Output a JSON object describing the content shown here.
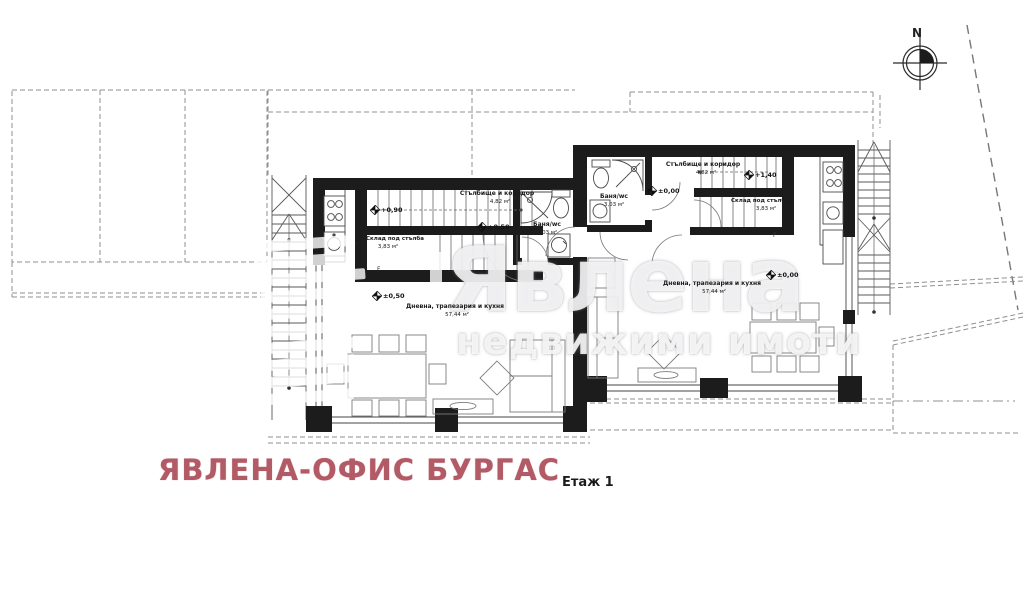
{
  "watermark": {
    "brand": "Явлена",
    "tagline": "недвижими имоти"
  },
  "title_block": {
    "office": "ЯВЛЕНА-ОФИС БУРГАС",
    "floor_label": "Етаж 1"
  },
  "compass": {
    "north": "N"
  },
  "units": {
    "left": {
      "stair_hall": {
        "name": "Стълбище и коридор",
        "area": "4,82 м²"
      },
      "storage": {
        "name": "Склад под стълба",
        "area": "3,83 м²"
      },
      "bath": {
        "name": "Баня/wc",
        "area": "3,03 м²"
      },
      "living": {
        "name": "Дневна, трапезария и кухня",
        "area": "57,44 м²"
      },
      "levels": {
        "entry": "+0,90",
        "hall": "±0,50",
        "living": "±0,50"
      },
      "fridge": "F"
    },
    "right": {
      "stair_hall": {
        "name": "Стълбище и коридор",
        "area": "4,82 м²"
      },
      "storage": {
        "name": "Склад под стълба",
        "area": "3,83 м²"
      },
      "bath": {
        "name": "Баня/wc",
        "area": "3,03 м²"
      },
      "living": {
        "name": "Дневна, трапезария и кухня",
        "area": "57,44 м²"
      },
      "levels": {
        "hall": "±0,00",
        "stairs": "+1,40",
        "living": "±0,00"
      },
      "fridge": "F"
    }
  },
  "colors": {
    "office_text": "#b25a66",
    "wall": "#1c1c1c",
    "dash": "#8f8f8f",
    "watermark": "#e9e9ec"
  }
}
